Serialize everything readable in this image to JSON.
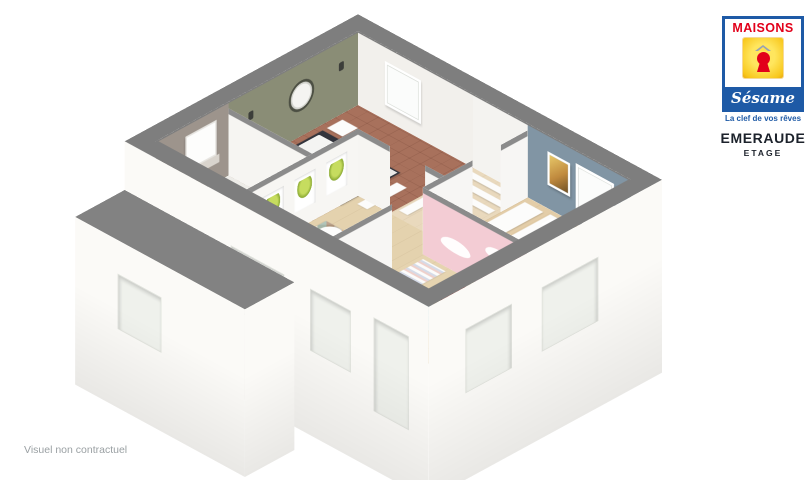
{
  "branding": {
    "maisons": "MAISONS",
    "sesame": "Sésame",
    "tagline": "La clef de vos rêves",
    "model": "EMERAUDE",
    "level": "ETAGE",
    "colors": {
      "blue": "#1e5aa6",
      "yellow": "#f8c71c",
      "red": "#e2001a",
      "text_dark": "#1c222b"
    }
  },
  "footer": {
    "disclaimer": "Visuel non contractuel"
  },
  "scene": {
    "type": "3d-floorplan-cutaway",
    "wall_top_color": "#7e7e7e",
    "rooms": [
      {
        "id": "master-bedroom",
        "accent_wall": "#8a8d76",
        "floor": "#a8715c"
      },
      {
        "id": "dressing",
        "accent_wall": "#f4f3f0",
        "floor": "#e9d9bd"
      },
      {
        "id": "bathroom",
        "accent_wall": "#9d948c",
        "floor": "#edece8"
      },
      {
        "id": "landing",
        "accent_wall": "#f6f5f2",
        "floor": "#e4d2ae"
      },
      {
        "id": "bedroom-blue",
        "accent_wall": "#8195a4",
        "floor": "#e3cda8"
      },
      {
        "id": "kids-bedroom",
        "accent_wall": "#f3ccd4",
        "floor": "#e6d4b0"
      }
    ]
  }
}
